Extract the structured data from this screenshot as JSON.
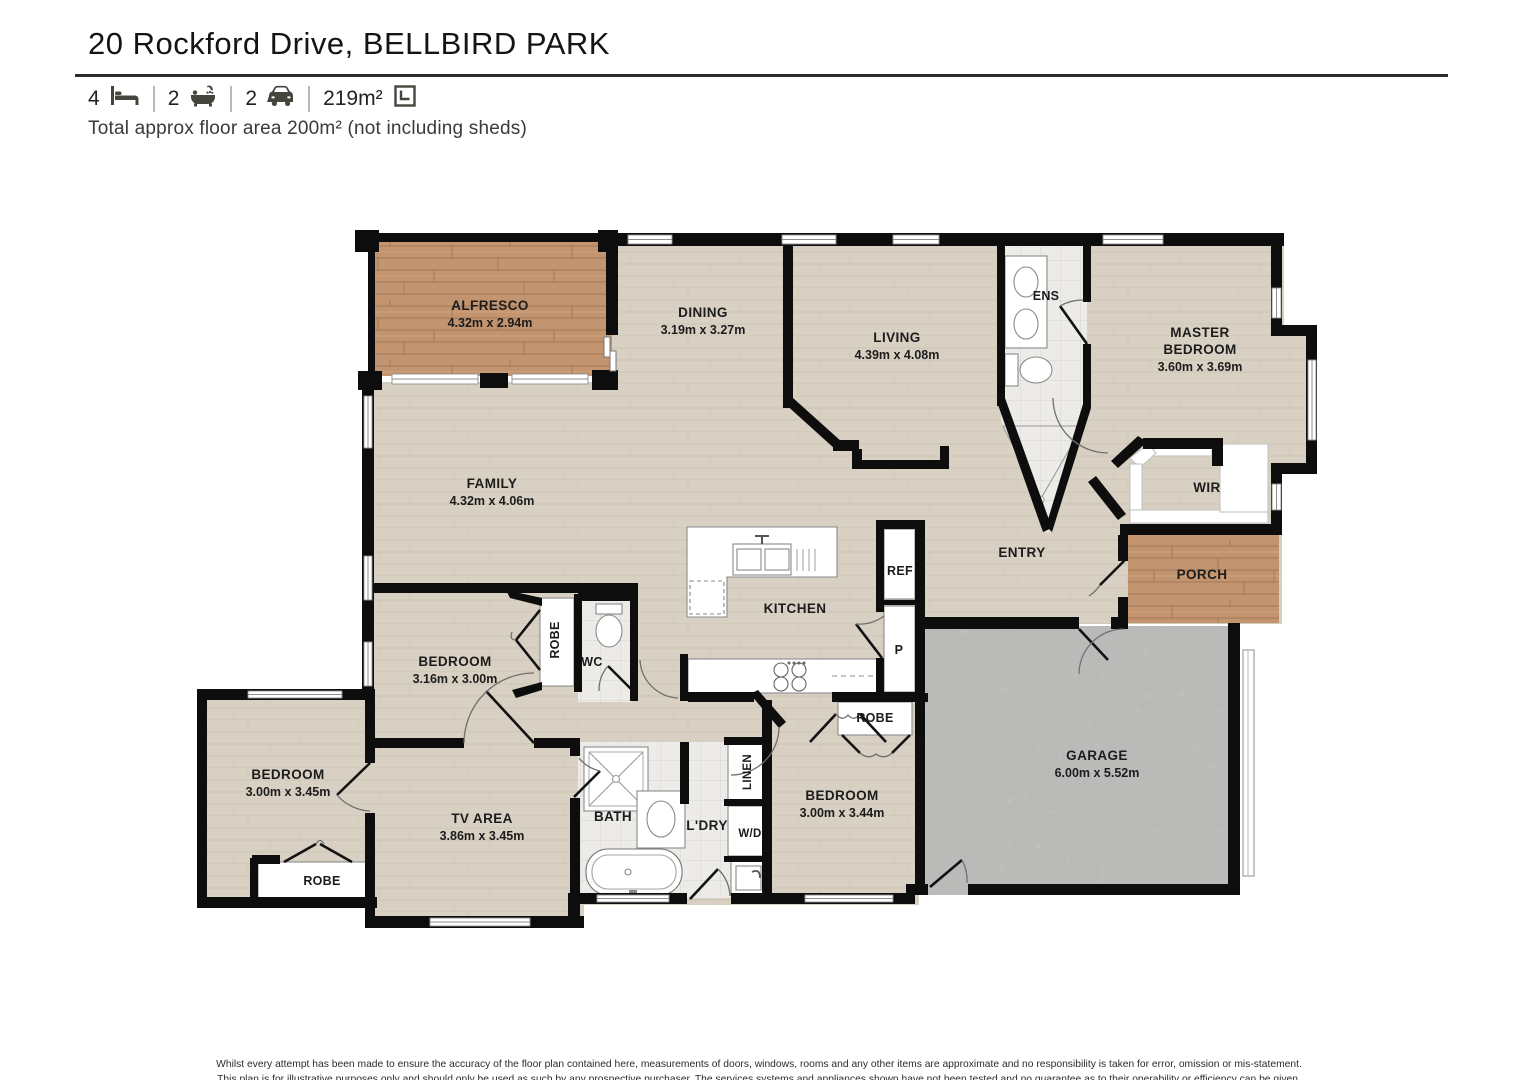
{
  "header": {
    "title": "20 Rockford Drive, BELLBIRD PARK",
    "beds": "4",
    "baths": "2",
    "cars": "2",
    "area": "219m²",
    "floor_note": "Total approx floor area 200m² (not including sheds)"
  },
  "rooms": {
    "alfresco": {
      "name": "ALFRESCO",
      "dims": "4.32m x 2.94m"
    },
    "dining": {
      "name": "DINING",
      "dims": "3.19m x 3.27m"
    },
    "living": {
      "name": "LIVING",
      "dims": "4.39m x 4.08m"
    },
    "ens": {
      "name": "ENS"
    },
    "master_bedroom": {
      "name_line1": "MASTER",
      "name_line2": "BEDROOM",
      "dims": "3.60m x 3.69m"
    },
    "family": {
      "name": "FAMILY",
      "dims": "4.32m x 4.06m"
    },
    "wir": {
      "name": "WIR"
    },
    "entry": {
      "name": "ENTRY"
    },
    "porch": {
      "name": "PORCH"
    },
    "kitchen": {
      "name": "KITCHEN"
    },
    "fridge": {
      "name": "REF"
    },
    "pantry": {
      "name": "P"
    },
    "robe_bed4": {
      "name": "ROBE"
    },
    "garage": {
      "name": "GARAGE",
      "dims": "6.00m x 5.52m"
    },
    "bedroom2": {
      "name": "BEDROOM",
      "dims": "3.16m x 3.00m"
    },
    "robe_bed2": {
      "name": "ROBE"
    },
    "wc": {
      "name": "WC"
    },
    "bedroom3": {
      "name": "BEDROOM",
      "dims": "3.00m x 3.45m"
    },
    "robe_bed3": {
      "name": "ROBE"
    },
    "tv_area": {
      "name": "TV AREA",
      "dims": "3.86m x 3.45m"
    },
    "bath": {
      "name": "BATH"
    },
    "laundry": {
      "name": "L'DRY"
    },
    "washer_dryer": {
      "name": "W/D"
    },
    "linen": {
      "name": "LINEN"
    },
    "bedroom4": {
      "name": "BEDROOM",
      "dims": "3.00m x 3.44m"
    }
  },
  "footer": {
    "line1": "Whilst every attempt has been made to ensure the accuracy of the floor plan contained here, measurements of doors, windows, rooms and any other items are approximate and no responsibility is taken for error, omission or mis-statement.",
    "line2": "This plan is for illustrative purposes only and should only be used as such by any prospective purchaser. The services systems and appliances shown have not been tested and no guarantee as to their operability or efficiency can be given."
  }
}
